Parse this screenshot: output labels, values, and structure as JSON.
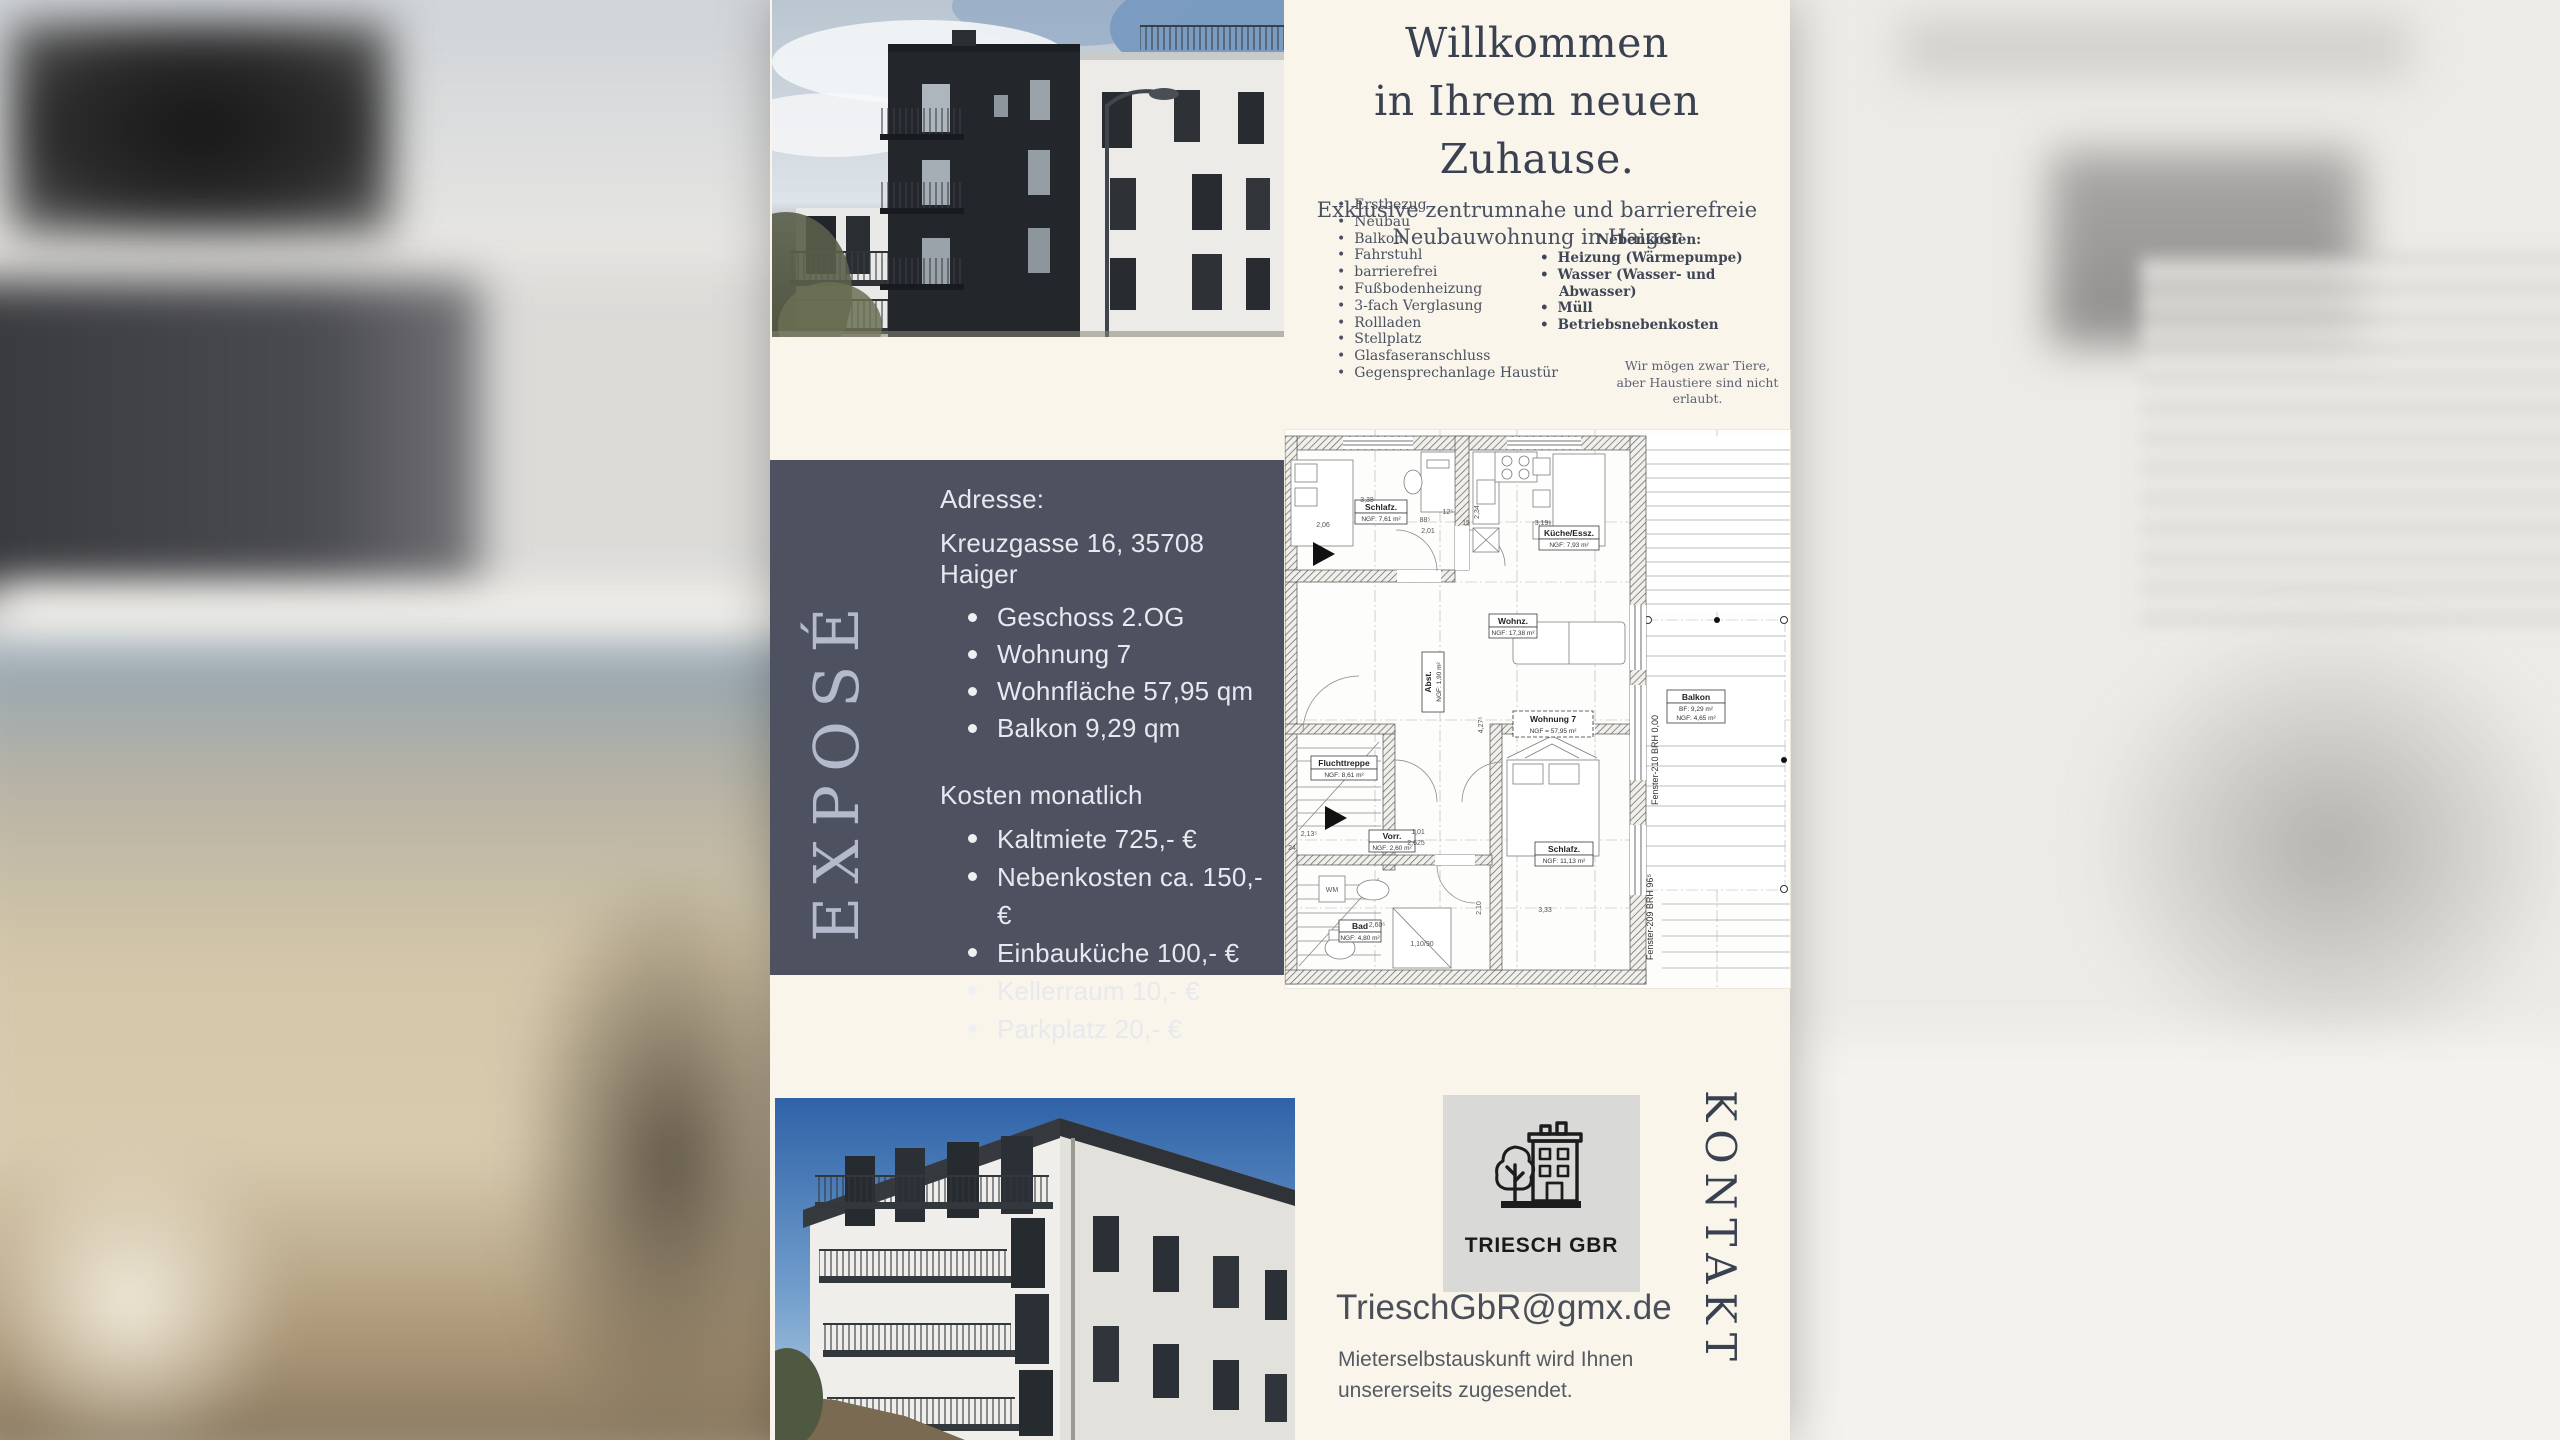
{
  "colors": {
    "cream": "#f9f5eb",
    "slate_box": "#4d5160",
    "heading_text": "#3a4150",
    "box_text": "#e7e9ef",
    "logo_bg": "#d9d9d8"
  },
  "hero": {
    "title_line1": "Willkommen",
    "title_line2": "in Ihrem neuen Zuhause.",
    "subtitle_line1": "Exklusive zentrumnahe und barrierefreie",
    "subtitle_line2": "Neubauwohnung in Haiger",
    "features": [
      "Erstbezug",
      "Neubau",
      "Balkon",
      "Fahrstuhl",
      "barrierefrei",
      "Fußbodenheizung",
      "3-fach Verglasung",
      "Rollladen",
      "Stellplatz",
      "Glasfaseranschluss",
      "Gegensprechanlage Haustür"
    ],
    "nebenkosten_heading": "Nebenkosten:",
    "nebenkosten_items": [
      "Heizung (Wärmepumpe)",
      "Wasser (Wasser- und Abwasser)",
      "Müll",
      "Betriebsnebenkosten"
    ],
    "pets_line1": "Wir mögen zwar Tiere,",
    "pets_line2": "aber Haustiere sind nicht erlaubt."
  },
  "expose": {
    "vertical_label": "EXPOSÉ",
    "address_label": "Adresse:",
    "address_value": "Kreuzgasse 16, 35708 Haiger",
    "address_items": [
      "Geschoss  2.OG",
      "Wohnung 7",
      "Wohnfläche 57,95 qm",
      "Balkon 9,29 qm"
    ],
    "costs_heading": "Kosten monatlich",
    "cost_items": [
      "Kaltmiete 725,- €",
      "Nebenkosten ca. 150,- €",
      "Einbauküche 100,- €",
      "Kellerraum 10,- €",
      "Parkplatz 20,- €"
    ]
  },
  "floorplan": {
    "rooms": [
      {
        "name": "Schlafz.",
        "area": "NGF: 7,61 m²"
      },
      {
        "name": "Küche/Essz.",
        "area": "NGF: 7,93 m²"
      },
      {
        "name": "Wohnz.",
        "area": "NGF: 17,38 m²"
      },
      {
        "name": "Abst.",
        "area": "NGF: 1,90 m²"
      },
      {
        "name": "Fluchttreppe",
        "area": "NGF: 8,61 m²"
      },
      {
        "name": "Vorr.",
        "area": "NGF: 2,60 m²"
      },
      {
        "name": "Bad",
        "area": "NGF: 4,80 m²"
      },
      {
        "name": "Schlafz.",
        "area": "NGF: 11,13 m²"
      }
    ],
    "balcony": {
      "name": "Balkon",
      "line2": "BF:  9,29 m²",
      "line3": "NGF: 4,65 m²"
    },
    "unit": {
      "name": "Wohnung 7",
      "area": "NGF = 57,95 m²"
    },
    "window_labels": [
      "Fenster-210  BRH  0,00",
      "Fenster-209  BRH  96⁵"
    ],
    "shower": "1,10/90",
    "wm": "WM",
    "dims": [
      "2,06",
      "3,38",
      "2,01",
      "88⁵",
      "12⁵",
      "15",
      "2,34",
      "3,19⁵",
      "4,27⁵",
      "3,33",
      "2,10",
      "2,60⁵",
      "1,01",
      "2,625",
      "2,13⁵",
      "24"
    ]
  },
  "contact": {
    "vertical_label": "KONTAKT",
    "logo_text": "TRIESCH GBR",
    "email": "TrieschGbR@gmx.de",
    "note_line1": "Mieterselbstauskunft wird Ihnen",
    "note_line2": "unsererseits zugesendet."
  }
}
